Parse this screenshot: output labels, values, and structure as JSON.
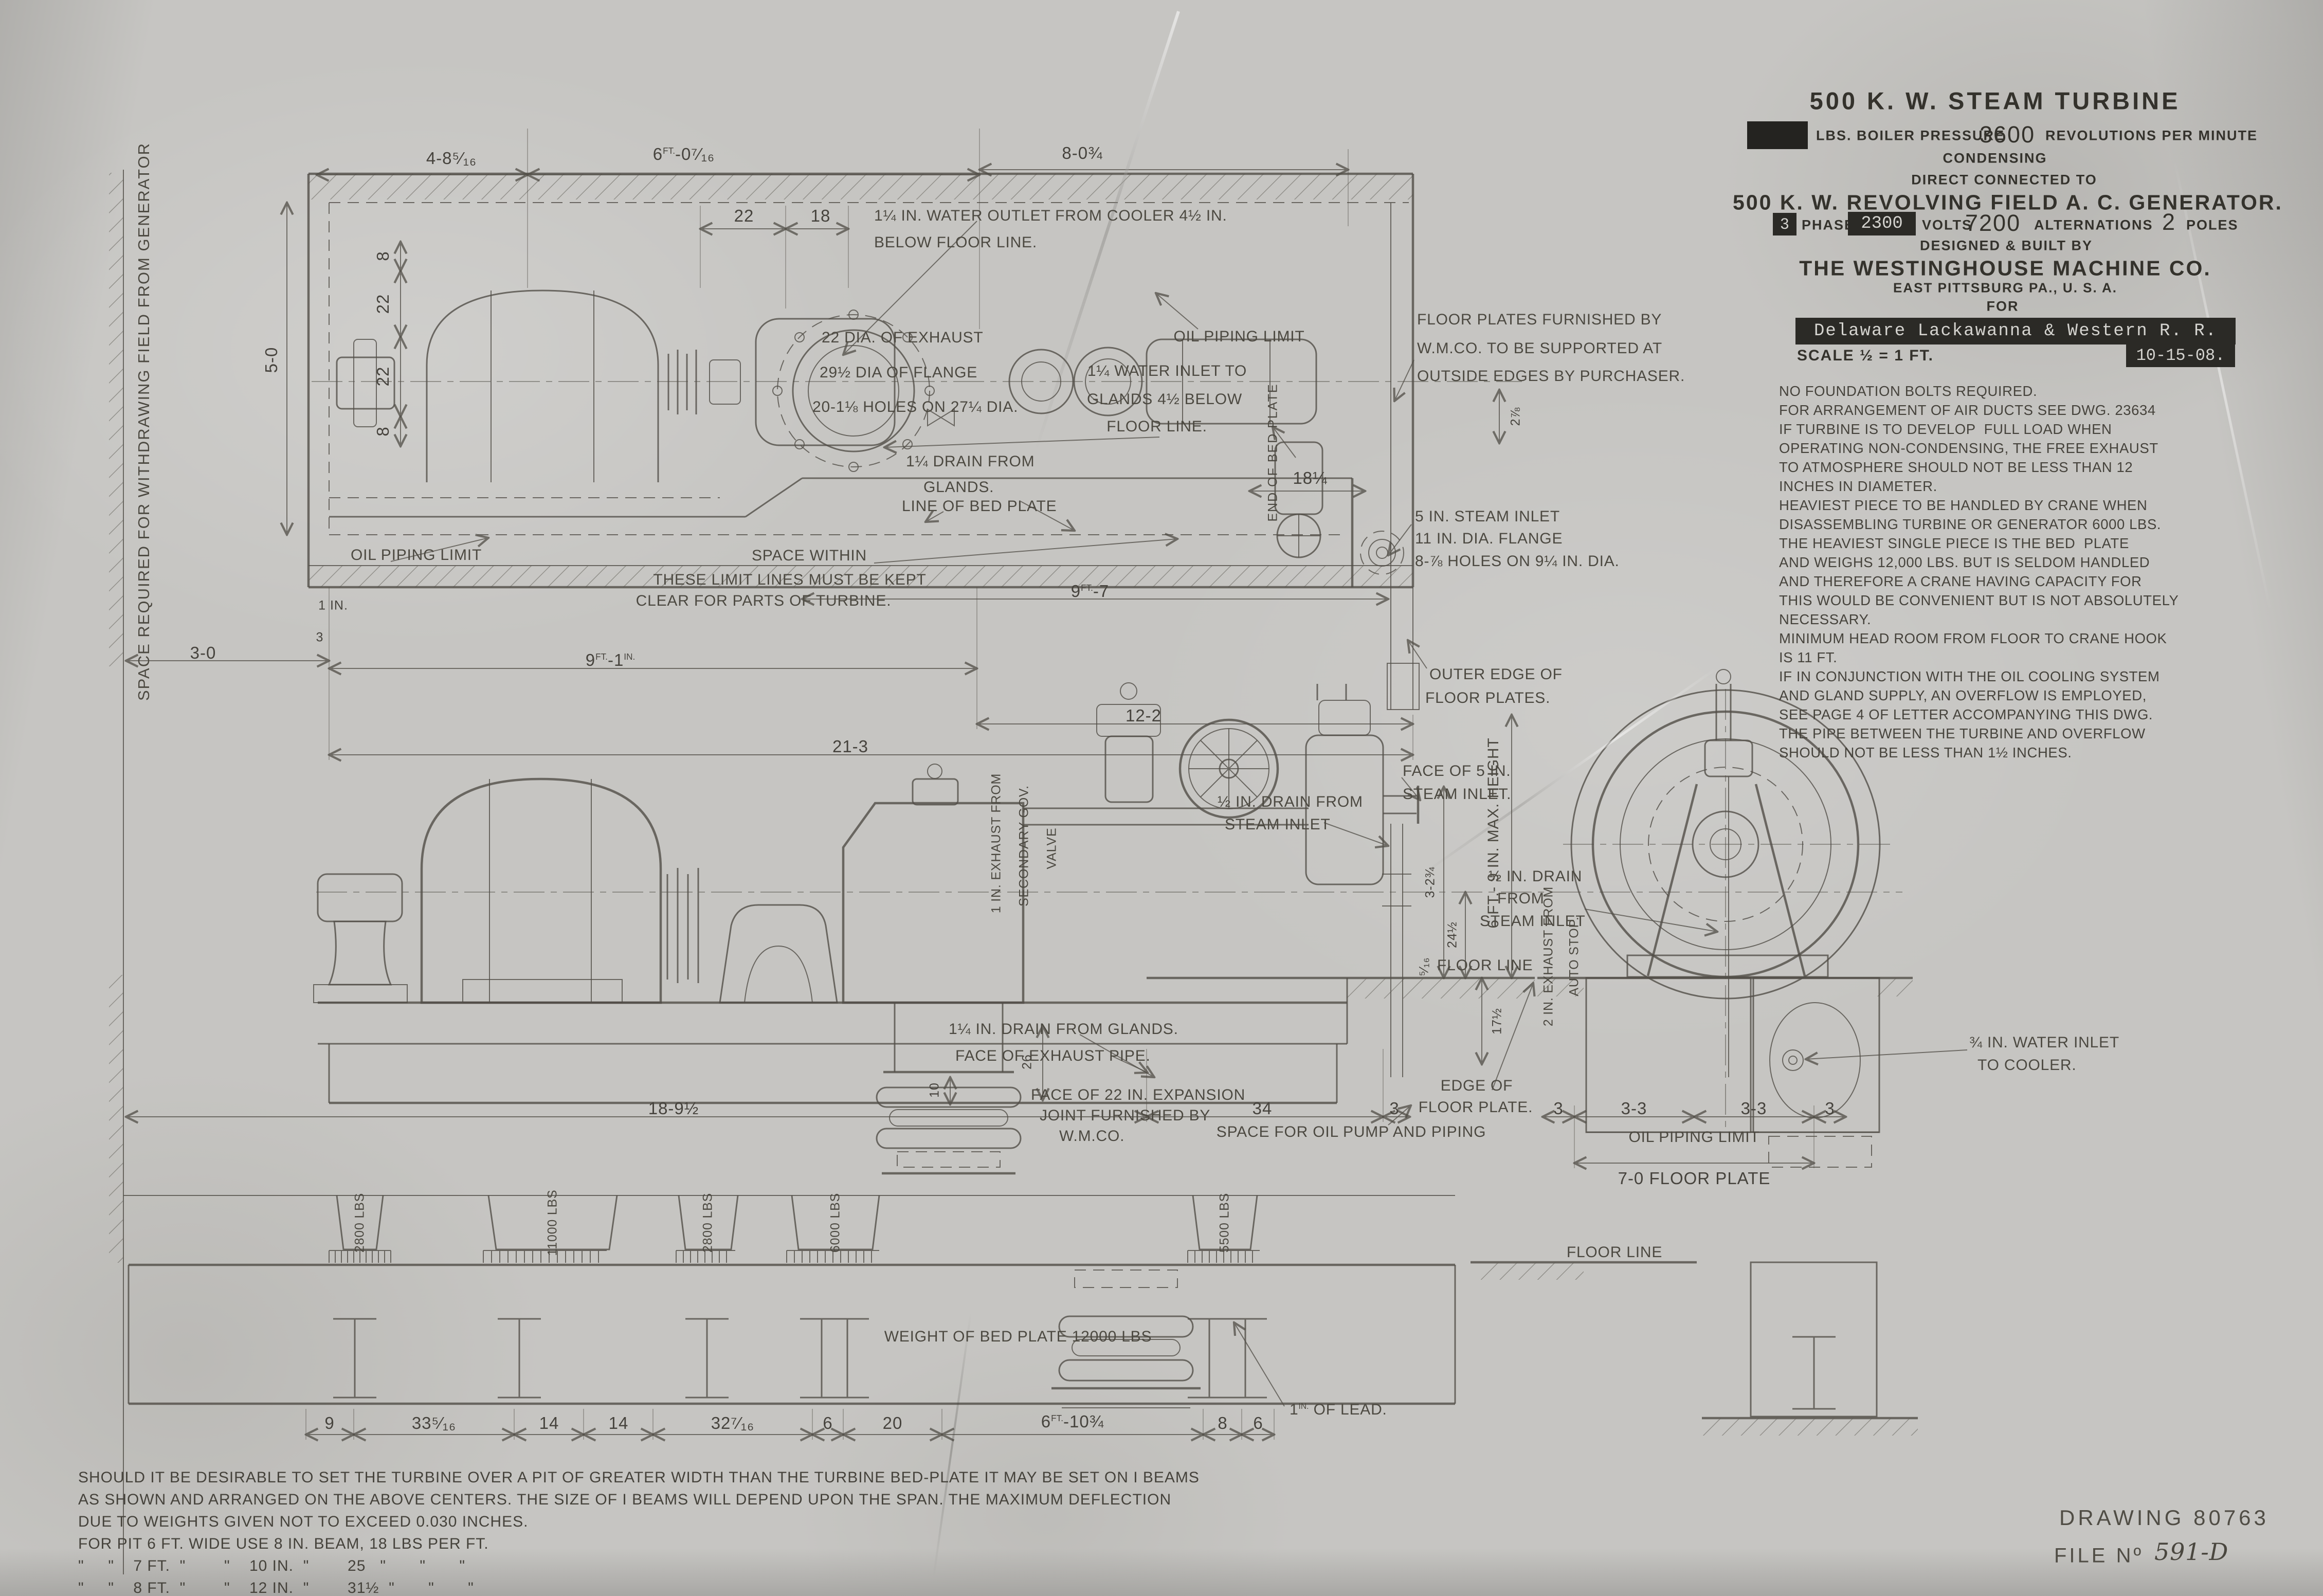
{
  "title_block": {
    "line1": "500 K. W. STEAM TURBINE",
    "boiler_label": "LBS. BOILER PRESSURE",
    "rpm_value": "3600",
    "rpm_label": "REVOLUTIONS PER MINUTE",
    "condensing": "CONDENSING",
    "direct": "DIRECT CONNECTED TO",
    "generator": "500 K. W. REVOLVING FIELD A. C. GENERATOR.",
    "phase_value": "3",
    "phase_label": "PHASE",
    "volts_value": "2300",
    "volts_label": "VOLTS",
    "alt_value": "7200",
    "alt_label": "ALTERNATIONS",
    "poles_value": "2",
    "poles_label": "POLES",
    "designed": "DESIGNED & BUILT BY",
    "company": "THE WESTINGHOUSE MACHINE CO.",
    "address": "EAST PITTSBURG PA., U. S. A.",
    "for": "FOR",
    "customer": "Delaware Lackawanna & Western R. R.",
    "scale": "SCALE ½ = 1 FT.",
    "date": "10-15-08."
  },
  "notes": {
    "lines": [
      "NO FOUNDATION BOLTS REQUIRED.",
      "FOR ARRANGEMENT OF AIR DUCTS SEE DWG. 23634",
      "IF TURBINE IS TO DEVELOP  FULL LOAD WHEN",
      "OPERATING NON-CONDENSING, THE FREE EXHAUST",
      "TO ATMOSPHERE SHOULD NOT BE LESS THAN 12",
      "INCHES IN DIAMETER.",
      "HEAVIEST PIECE TO BE HANDLED BY CRANE WHEN",
      "DISASSEMBLING TURBINE OR GENERATOR 6000 LBS.",
      "THE HEAVIEST SINGLE PIECE IS THE BED  PLATE",
      "AND WEIGHS 12,000 LBS. BUT IS SELDOM HANDLED",
      "AND THEREFORE A CRANE HAVING CAPACITY FOR",
      "THIS WOULD BE CONVENIENT BUT IS NOT ABSOLUTELY",
      "NECESSARY.",
      "MINIMUM HEAD ROOM FROM FLOOR TO CRANE HOOK",
      "IS 11 FT.",
      "IF IN CONJUNCTION WITH THE OIL COOLING SYSTEM",
      "AND GLAND SUPPLY, AN OVERFLOW IS EMPLOYED,",
      "SEE PAGE 4 OF LETTER ACCOMPANYING THIS DWG.",
      "THE PIPE BETWEEN THE TURBINE AND OVERFLOW",
      "SHOULD NOT BE LESS THAN 1½ INCHES."
    ]
  },
  "margin": {
    "space_required": "SPACE REQUIRED FOR WITHDRAWING FIELD FROM GENERATOR"
  },
  "plan": {
    "d48": "4-8⁵⁄₁₆",
    "d60": {
      "p1": "6",
      "sup": "FT.",
      "p2": "-0⁷⁄₁₆"
    },
    "d22": "22",
    "d18": "18",
    "d80": "8-0¾",
    "water_outlet_1": "1¼ IN. WATER OUTLET FROM COOLER 4½ IN.",
    "water_outlet_2": "BELOW FLOOR LINE.",
    "exhaust_1": "22 DIA. OF EXHAUST",
    "exhaust_2": "29½ DIA OF FLANGE",
    "exhaust_3": "20-1⅛ HOLES ON 27¼ DIA.",
    "oil_limit_top": "OIL PIPING LIMIT",
    "water_inlet_1": "1¼ WATER INLET TO",
    "water_inlet_2": "GLANDS 4½ BELOW",
    "water_inlet_3": "FLOOR LINE.",
    "end_of_bed": "END OF BED PLATE",
    "floor_plates_1": "FLOOR PLATES FURNISHED BY",
    "floor_plates_2": "W.M.CO. TO BE SUPPORTED AT",
    "floor_plates_3": "OUTSIDE EDGES BY PURCHASER.",
    "d8a": "8",
    "d22a": "22",
    "d22b": "22",
    "d8b": "8",
    "d50": "5-0",
    "drain_glands_1": "1¼ DRAIN FROM",
    "drain_glands_2": "GLANDS.",
    "steam_inlet_1": "5 IN. STEAM INLET",
    "steam_inlet_2": "11 IN. DIA. FLANGE",
    "steam_inlet_3": "8-⅞ HOLES ON 9¼ IN. DIA.",
    "d278": "2⅞",
    "d18q": "18¼",
    "line_of_bed": "LINE OF BED PLATE",
    "space_within_1": "SPACE WITHIN",
    "space_within_2": "THESE LIMIT LINES MUST BE KEPT",
    "space_within_3": "CLEAR FOR PARTS OF TURBINE.",
    "oil_limit_bottom": "OIL PIPING LIMIT",
    "d1in": "1 IN.",
    "d3s": "3",
    "d97": {
      "p1": "9",
      "sup": "FT.",
      "p2": "-7"
    },
    "outer_edge_1": "OUTER EDGE OF",
    "outer_edge_2": "FLOOR PLATES.",
    "d30": "3-0",
    "d91": {
      "p1": "9",
      "sup": "FT.",
      "p2": "-1",
      "sup2": "IN."
    },
    "d122": "12-2",
    "d213": "21-3"
  },
  "elevation": {
    "face5_1": "FACE OF 5 IN.",
    "face5_2": "STEAM INLET.",
    "drain_steam_1": "½ IN. DRAIN FROM",
    "drain_steam_2": "STEAM INLET",
    "max_height": "6 FT.- 9 IN. MAX. HEIGHT",
    "exh_sec_1": "1 IN. EXHAUST FROM",
    "exh_sec_2": "SECONDARY GOV.",
    "exh_sec_3": "VALVE",
    "d3234": "3-2¾",
    "d245": "24½",
    "d516": "⁵⁄₁₆",
    "floor_line": "FLOOR LINE",
    "d175": "17½",
    "d26": "26",
    "drain_glands": "1¼ IN. DRAIN FROM GLANDS.",
    "face_exhaust": "FACE OF EXHAUST PIPE.",
    "exp_joint_1": "FACE OF 22 IN. EXPANSION",
    "exp_joint_2": "JOINT FURNISHED BY",
    "exp_joint_3": "W.M.CO.",
    "d189": "18-9½",
    "d34": "34",
    "d3a": "3",
    "space_oil": "SPACE FOR OIL PUMP AND PIPING",
    "edge_floor_1": "EDGE OF",
    "edge_floor_2": "FLOOR PLATE.",
    "d10": "10"
  },
  "end_view": {
    "drain_steam_1": "½ IN. DRAIN",
    "drain_steam_2": "FROM",
    "drain_steam_3": "STEAM INLET",
    "exh_auto_1": "2 IN. EXHAUST FROM",
    "exh_auto_2": "AUTO STOP.",
    "water_cooler_1": "¾ IN. WATER INLET",
    "water_cooler_2": "TO COOLER.",
    "d3l": "3",
    "d33a": "3-3",
    "d33b": "3-3",
    "d3r": "3",
    "oil_limit": "OIL PIPING LIMIT",
    "floor_plate": "7-0 FLOOR PLATE"
  },
  "foundation": {
    "w1": "2800 LBS",
    "w2": "11000 LBS",
    "w3": "2800 LBS",
    "w4": "6000 LBS",
    "w5": "5500 LBS",
    "floor_line": "FLOOR LINE",
    "bed_weight": "WEIGHT OF BED PLATE 12000 LBS",
    "lead": {
      "p1": "1",
      "sup": "IN.",
      "p2": " OF LEAD."
    },
    "d9": "9",
    "d3316": "33⁵⁄₁₆",
    "d14a": "14",
    "d14b": "14",
    "d3276": "32⁷⁄₁₆",
    "d6a": "6",
    "d20": "20",
    "d6103": {
      "p1": "6",
      "sup": "FT.",
      "p2": "-10¾"
    },
    "d8": "8",
    "d6b": "6"
  },
  "pit_note": {
    "lines": [
      "SHOULD IT BE DESIRABLE TO SET THE TURBINE OVER A PIT OF GREATER WIDTH THAN THE TURBINE BED-PLATE IT MAY BE SET ON I BEAMS",
      "AS SHOWN AND ARRANGED ON THE ABOVE CENTERS. THE SIZE OF I BEAMS WILL DEPEND UPON THE SPAN. THE MAXIMUM DEFLECTION",
      "DUE TO WEIGHTS GIVEN NOT TO EXCEED 0.030 INCHES.",
      "FOR PIT 6 FT. WIDE USE 8 IN. BEAM, 18 LBS PER FT.",
      "\"     \"    7 FT.  \"        \"    10 IN.  \"        25   \"       \"       \"",
      "\"     \"    8 FT.  \"        \"    12 IN.  \"        31½  \"       \"       \""
    ]
  },
  "footer": {
    "drawing": "DRAWING 80763",
    "file_label": "FILE Nº",
    "file_value": "591-D"
  }
}
